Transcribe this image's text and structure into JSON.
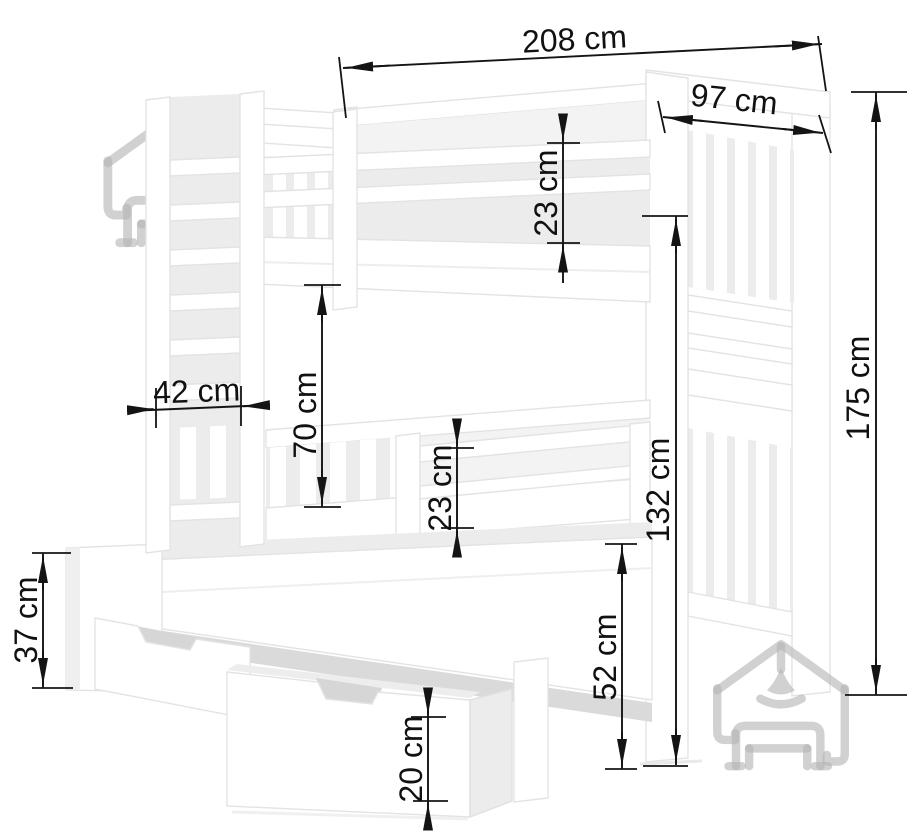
{
  "drawing": {
    "unit": "cm",
    "colors": {
      "dimension_lines": "#141414",
      "bed_edges": "#e3e3e3",
      "bed_shading": "#ececec",
      "watermark": "#b3b3b3",
      "background": "#ffffff"
    }
  },
  "dimensions": {
    "length": {
      "label": "208 cm"
    },
    "width": {
      "label": "97 cm"
    },
    "upper_guard_height": {
      "label": "23 cm"
    },
    "ladder_width": {
      "label": "42 cm"
    },
    "bunk_gap_height": {
      "label": "70 cm"
    },
    "trundle_guard_height": {
      "label": "23 cm"
    },
    "lower_section_height": {
      "label": "132 cm"
    },
    "total_height": {
      "label": "175 cm"
    },
    "trundle_end_height": {
      "label": "37 cm"
    },
    "trundle_height": {
      "label": "52 cm"
    },
    "drawer_height": {
      "label": "20 cm"
    }
  }
}
